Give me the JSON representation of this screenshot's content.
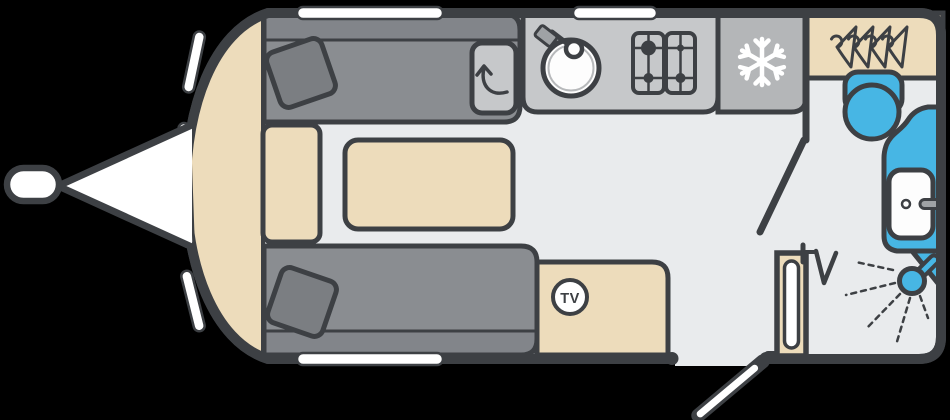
{
  "page": {
    "title": "caravan-floorplan",
    "background": "#000000"
  },
  "labels": {
    "tv": "TV"
  },
  "colors": {
    "outline": "#3d4044",
    "floor": "#e9ebed",
    "front_trim": "#eddcbb",
    "upholstery": "#8a8d91",
    "upholstery_shade": "#82858a",
    "cushion": "#7b7e82",
    "furniture_wood": "#eddcbb",
    "worktop": "#c6c8ca",
    "fridge": "#b4b6b8",
    "fixture_blue": "#47b6e4",
    "window_white": "#ffffff",
    "metal": "#9fa2a5"
  },
  "areas": {
    "lounge": {
      "name": "front-lounge",
      "items": [
        "front-storage-chest",
        "bench-seat-top",
        "bench-seat-bottom",
        "scatter-cushions",
        "table",
        "worktop-extension-flap",
        "tv-point"
      ]
    },
    "kitchen": {
      "name": "kitchen",
      "items": [
        "round-sink-with-tap",
        "four-burner-hob",
        "fridge"
      ]
    },
    "washroom": {
      "name": "end-washroom",
      "items": [
        "wardrobe",
        "toilet",
        "washbasin-with-tap",
        "shower",
        "heater",
        "tv-aerial-point"
      ]
    },
    "exterior": {
      "items": [
        "tow-hitch-ball",
        "a-frame",
        "entrance-door-open",
        "windows"
      ]
    }
  },
  "windows": {
    "front_dashes": 3,
    "top": 2,
    "bottom": 1
  },
  "icons": {
    "fridge": "snowflake-icon",
    "wardrobe": "coat-hangers-icon",
    "tv_point": "tv-circle-badge",
    "aerial": "tv-aerial-icon",
    "shower": "shower-spray-icon",
    "flap": "swivel-arrow-icon"
  }
}
